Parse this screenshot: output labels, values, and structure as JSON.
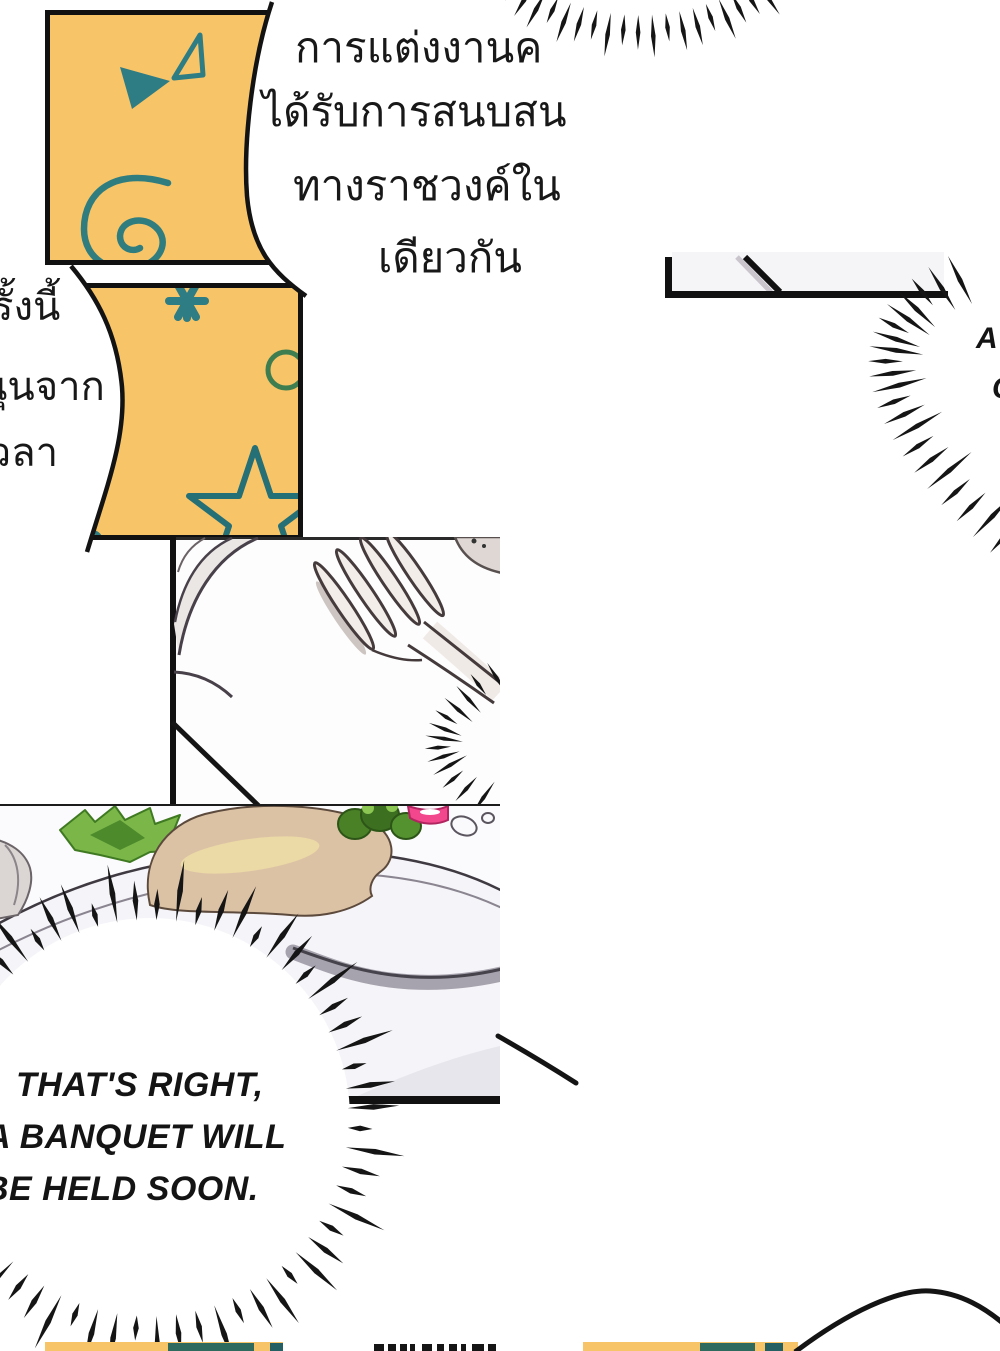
{
  "page": {
    "kind": "manga-page",
    "width": 1000,
    "height": 1351,
    "background": "#ffffff"
  },
  "colors": {
    "panel_fill": "#f8c468",
    "doodle_teal": "#2e7c84",
    "doodle_green": "#3e7d4f",
    "ink": "#141414",
    "food_region_bg": "#f5f4f8",
    "plate_band_gray": "#a7a3ae",
    "food_tan": "#dcc2a4",
    "food_green": "#7ab648",
    "food_pink": "#f2478d"
  },
  "speech": {
    "thai_main": {
      "lines": [
        "การแต่งงานค",
        "ได้รับการสนบสน",
        "ทางราชวงค์ใน",
        "เดียวกัน"
      ]
    },
    "thai_left": {
      "lines": [
        "รั้งนี้",
        "นุนจาก",
        "เวลา"
      ]
    },
    "burst_english": {
      "lines": [
        "THAT'S RIGHT,",
        "A BANQUET WILL",
        "BE HELD SOON."
      ]
    },
    "burst_right_fragments": [
      "A",
      "C"
    ]
  }
}
